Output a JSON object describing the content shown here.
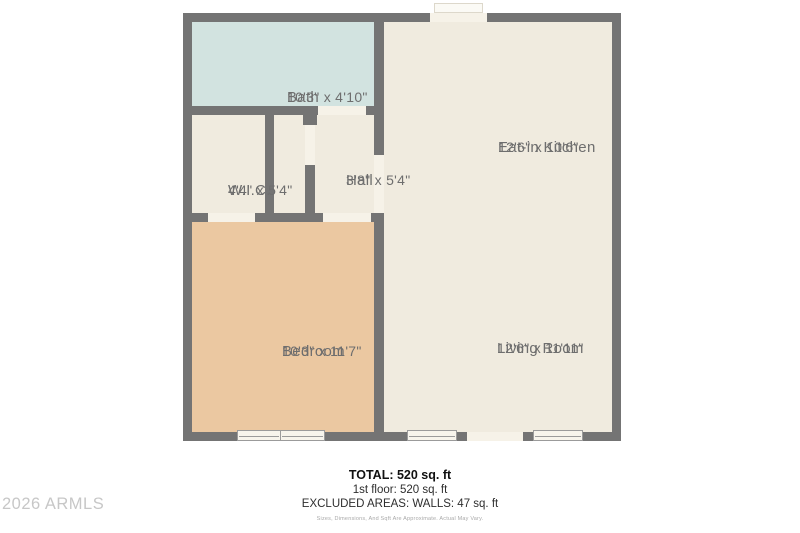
{
  "floor_plan": {
    "rooms": {
      "bath": {
        "name": "Bath",
        "dims": "10'3\" x 4'10\""
      },
      "wic": {
        "name": "W.I.C.",
        "dims": "4'4\" x 5'4\""
      },
      "hall": {
        "name": "Hall",
        "dims": "3'8\" x 5'4\""
      },
      "kitchen": {
        "name": "Eat-in Kitchen",
        "dims": "12'6\" x 10'6\""
      },
      "bedroom": {
        "name": "Bedroom",
        "dims": "10'3\" x 11'7\""
      },
      "living": {
        "name": "Living Room",
        "dims": "12'6\" x 11'11\""
      }
    },
    "colors": {
      "wall": "#747474",
      "floor": "#f0ebdf",
      "bath_floor": "#d2e3e0",
      "bedroom_floor": "#ebc8a1"
    }
  },
  "summary": {
    "total": "TOTAL: 520 sq. ft",
    "first_floor": "1st floor: 520 sq. ft",
    "excluded": "EXCLUDED AREAS: WALLS: 47 sq. ft",
    "disclaimer": "Sizes, Dimensions, And Sqft Are Approximate. Actual May Vary."
  },
  "watermark": "2026 ARMLS"
}
